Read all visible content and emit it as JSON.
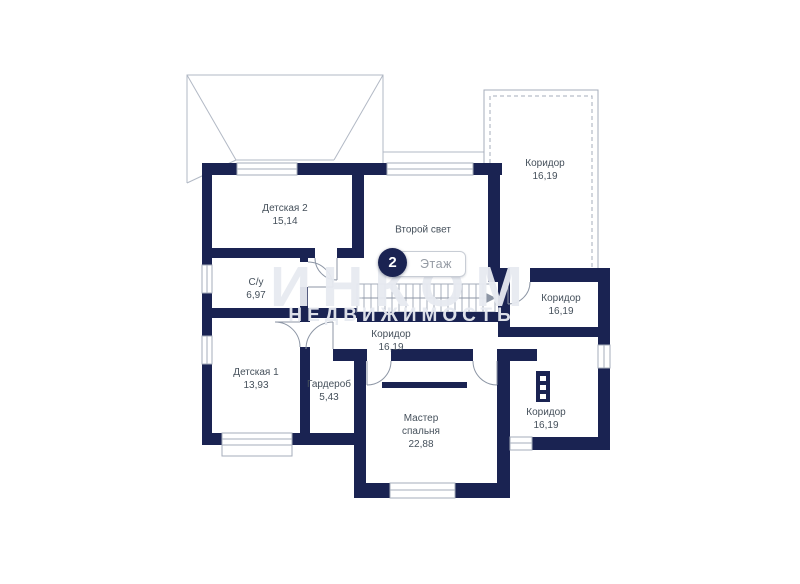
{
  "floor_badge": {
    "number": "2",
    "label": "Этаж"
  },
  "watermark": {
    "line1": "ИНКОМ",
    "line2": "НЕДВИЖИМОСТЬ"
  },
  "rooms": [
    {
      "name": "Детская 2",
      "area": "15,14"
    },
    {
      "name": "С/у",
      "area": "6,97"
    },
    {
      "name": "Детская 1",
      "area": "13,93"
    },
    {
      "name": "Гардероб",
      "area": "5,43"
    },
    {
      "name": "Второй свет",
      "area": ""
    },
    {
      "name": "Мастер спальня",
      "area": "22,88"
    },
    {
      "name": "Коридор",
      "area": "16,19"
    },
    {
      "name": "Коридор",
      "area": "16,19"
    },
    {
      "name": "Коридор",
      "area": "16,19"
    },
    {
      "name": "Коридор",
      "area": "16,19"
    }
  ],
  "colors": {
    "wall": "#1a2352",
    "thin_line": "#a6adbb",
    "label": "#45505b",
    "watermark": "#e7eaf0"
  }
}
